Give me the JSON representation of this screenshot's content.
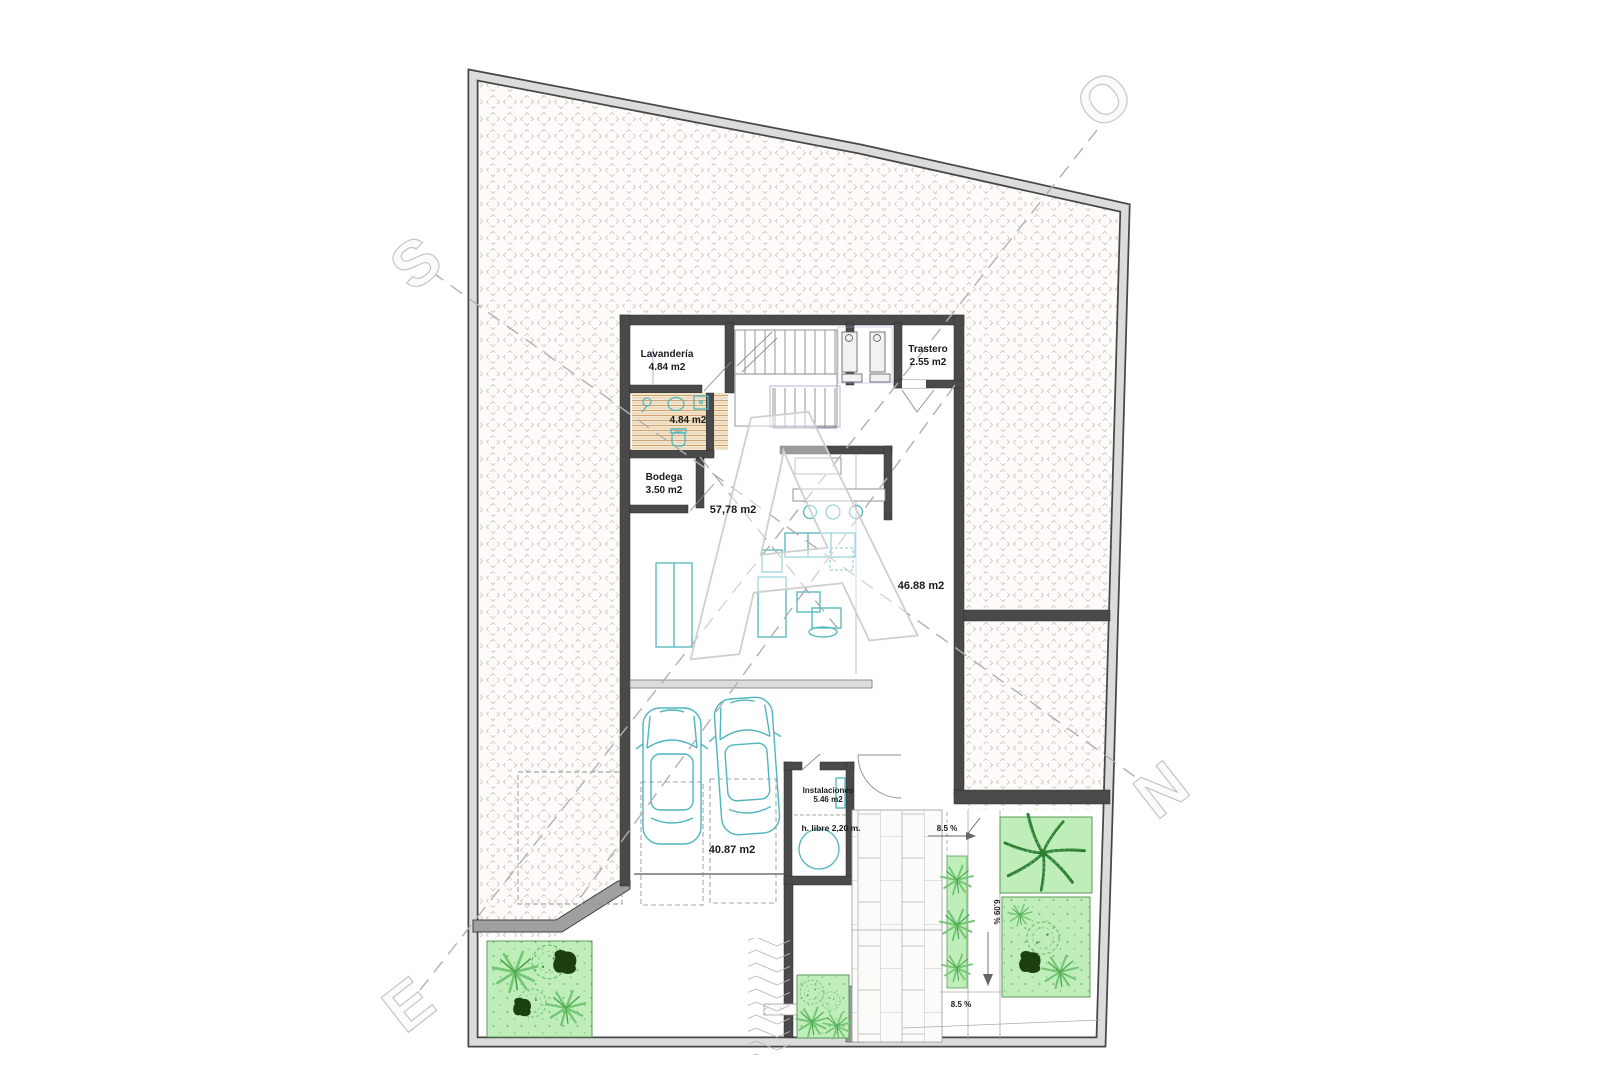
{
  "drawing": {
    "type": "architectural-floor-plan-basement",
    "rooms": {
      "lavanderia": {
        "name": "Lavandería",
        "area": "4.84 m2"
      },
      "bano": {
        "area": "4.84 m2"
      },
      "trastero": {
        "name": "Trastero",
        "area": "2.55 m2"
      },
      "bodega": {
        "name": "Bodega",
        "area": "3.50 m2"
      },
      "salon": {
        "area": "57,78 m2"
      },
      "patio": {
        "area": "46.88 m2"
      },
      "instalaciones": {
        "name": "Instalaciones",
        "area": "5.46 m2",
        "headroom": "h. libre 2,20 m."
      },
      "garaje": {
        "area": "40.87 m2"
      }
    },
    "ramp": {
      "slope_upper": "8.5 %",
      "slope_lower": "8.5 %",
      "slope_side": "6.09 %"
    },
    "watermark": {
      "letter_s": "S",
      "letter_o": "O",
      "letter_a": "A",
      "letter_n": "N",
      "letter_e": "E"
    },
    "colors": {
      "wall": "#474747",
      "hatch": "#cdc2b4",
      "furniture_teal": "#4fb6bd",
      "garden_fill": "#bfeebb",
      "plant_green": "#6fc86f",
      "plant_dark": "#1c3f12",
      "guide_blue": "#98a0d4"
    }
  }
}
